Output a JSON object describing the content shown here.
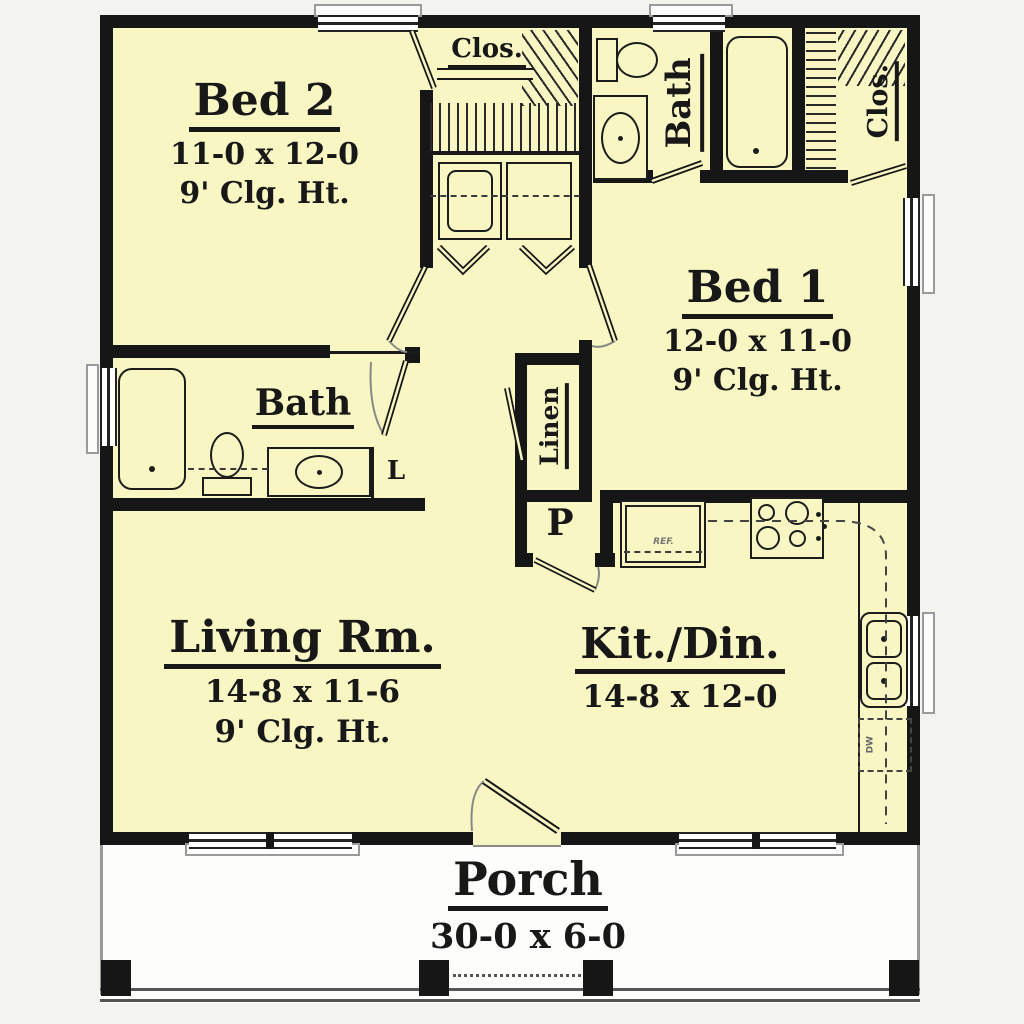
{
  "rooms": {
    "bed2": {
      "name": "Bed 2",
      "dims": "11-0 x 12-0",
      "ceiling": "9' Clg. Ht."
    },
    "bed1": {
      "name": "Bed 1",
      "dims": "12-0 x 11-0",
      "ceiling": "9' Clg. Ht."
    },
    "living_room": {
      "name": "Living Rm.",
      "dims": "14-8 x 11-6",
      "ceiling": "9' Clg. Ht."
    },
    "kitchen_dining": {
      "name": "Kit./Din.",
      "dims": "14-8 x 12-0"
    },
    "porch": {
      "name": "Porch",
      "dims": "30-0 x 6-0"
    },
    "bath_hall": {
      "name": "Bath"
    },
    "bath_top": {
      "name": "Bath"
    },
    "closet_hall": {
      "name": "Clos."
    },
    "closet_master": {
      "name": "Clos."
    },
    "linen": {
      "name": "Linen"
    },
    "pantry": {
      "name": "P"
    },
    "linen_small": {
      "name": "L"
    }
  },
  "appliances": {
    "refrigerator": "REF.",
    "dishwasher": "DW"
  },
  "colors": {
    "floor": "#f8f7c3",
    "wall": "#161616",
    "porch": "#fdfdfb",
    "background": "#f3f3ef",
    "window_frame": "#9a9a9a"
  }
}
